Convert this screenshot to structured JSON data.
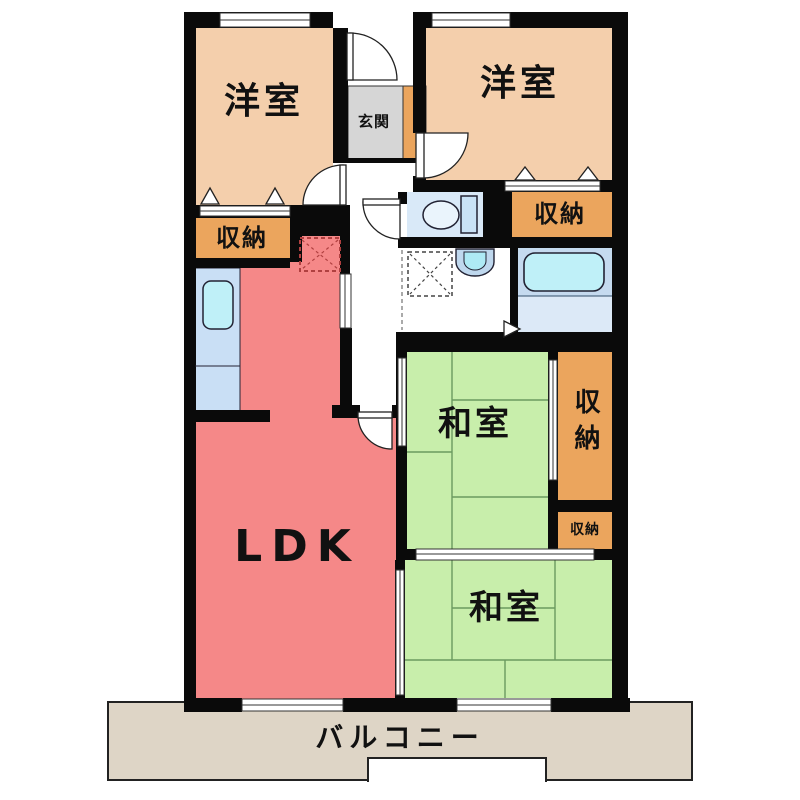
{
  "rooms": {
    "yoshitsu_left": {
      "label": "洋室"
    },
    "yoshitsu_right": {
      "label": "洋室"
    },
    "washitsu_1": {
      "label": "和室"
    },
    "washitsu_2": {
      "label": "和室"
    },
    "ldk": {
      "label": "LDK"
    },
    "genkan": {
      "label": "玄関"
    },
    "balcony": {
      "label": "バルコニー"
    },
    "closet_left": {
      "label": "収納"
    },
    "closet_top_right": {
      "label": "収納"
    },
    "closet_tall_right": {
      "label": "収納"
    },
    "closet_small_right": {
      "label": "収納"
    }
  },
  "fixtures": {
    "toilet": "toilet-bowl-with-tank",
    "bathtub": "bathtub",
    "kitchen_sink": "kitchen-counter-sink",
    "washbasin": "washbasin",
    "washing_machine_space": "dashed-square-x",
    "refrigerator_space": "dashed-square-x"
  },
  "colors": {
    "western_room": "#F4CFAC",
    "japanese_room": "#C8EEAB",
    "ldk": "#F58888",
    "closet": "#EBA55D",
    "entrance": "#D6D6D6",
    "balcony": "#DED5C6",
    "bath_floor": "#C5DAEF",
    "fixture_water": "#BFF0F8",
    "toilet_room": "#D9E9F8",
    "wall": "#0A0A0A"
  }
}
